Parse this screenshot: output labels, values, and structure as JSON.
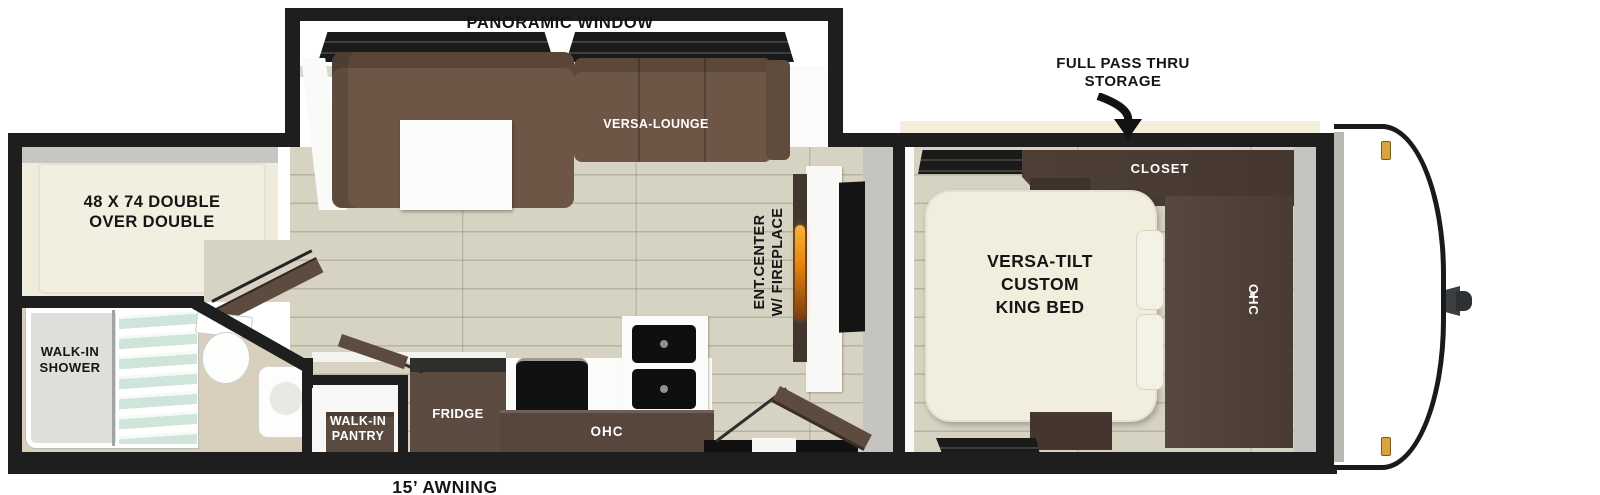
{
  "floorplan": {
    "slideout": {
      "panoramic_window": "PANORAMIC WINDOW",
      "versa_lounge": "VERSA-LOUNGE"
    },
    "exterior": {
      "pass_thru_storage": "FULL PASS THRU\nSTORAGE",
      "awning": "15’ AWNING"
    },
    "bedroom": {
      "closet": "CLOSET",
      "king_bed": "VERSA-TILT\nCUSTOM\nKING BED",
      "overhead_cabinet": "OHC"
    },
    "living": {
      "ent_center": "ENT.CENTER\nW/ FIREPLACE"
    },
    "kitchen": {
      "fridge": "FRIDGE",
      "overhead_cabinet": "OHC",
      "pantry": "WALK-IN\nPANTRY"
    },
    "bunk_room": {
      "bed": "48 X 74 DOUBLE\nOVER DOUBLE"
    },
    "bathroom": {
      "shower": "WALK-IN\nSHOWER"
    }
  },
  "colors": {
    "wall": "#1e1e1e",
    "floor": "#d7d3c2",
    "sofa": "#6d5646",
    "cabinet": "#56463c",
    "cabinet-dark": "#463830",
    "bed": "#f1eede",
    "fire": "#e8860f",
    "marker": "#d9a440",
    "glass": "#cfe5da",
    "label-dark": "#151515",
    "label-light": "#ffffff"
  }
}
